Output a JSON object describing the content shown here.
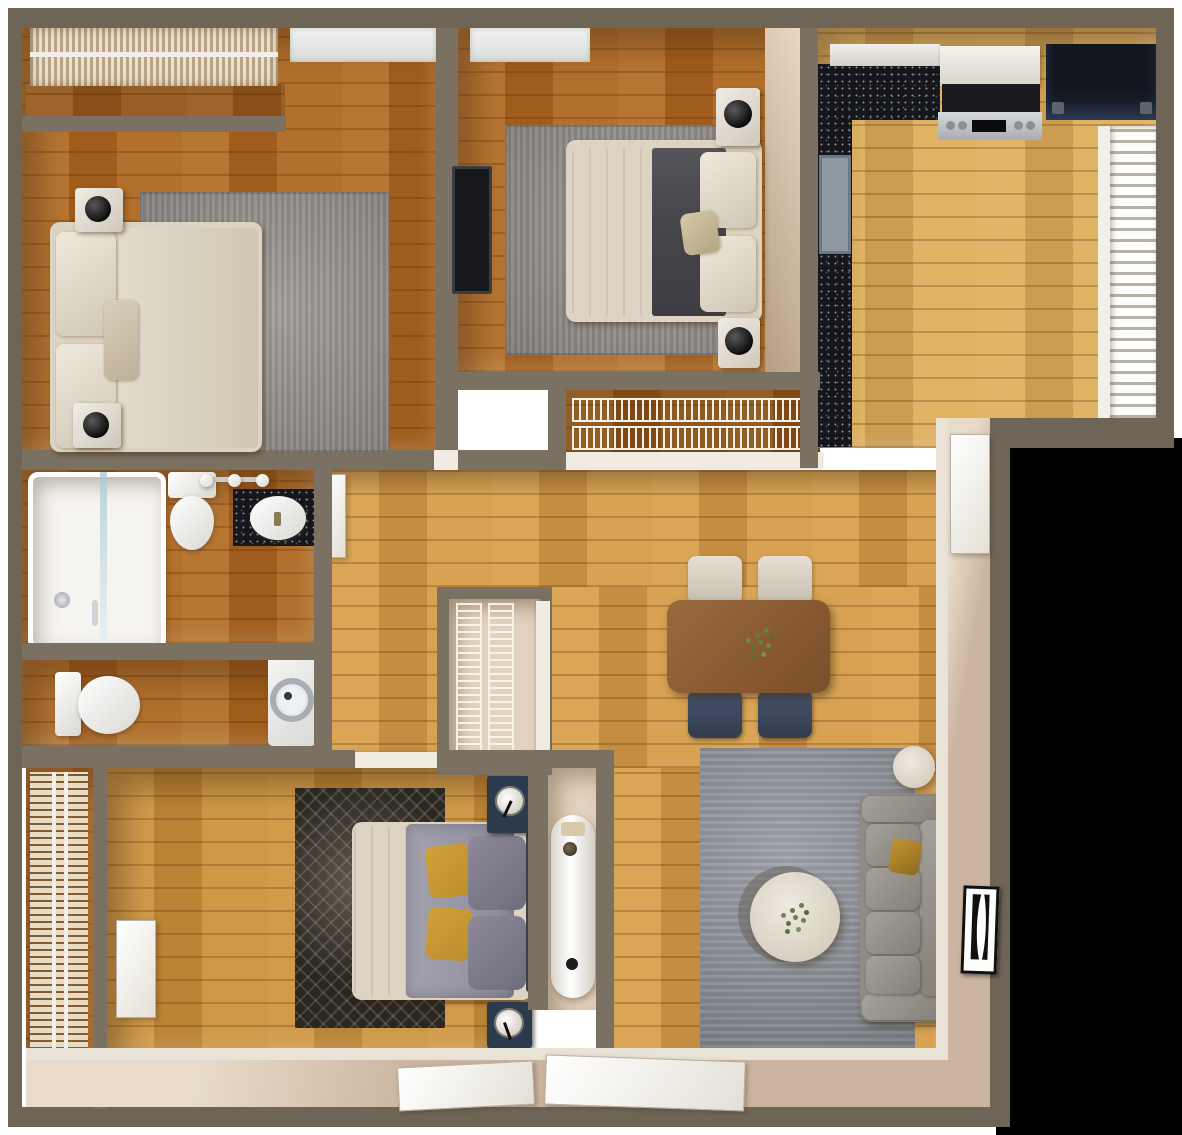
{
  "title": "Top-down 3D render floor plan of a two-bedroom-plus-den apartment",
  "palette": {
    "wall": "#6f6557",
    "wallInner": "#7b7163",
    "beige": "#e3d2bf",
    "beigeDeep": "#cdb9a2",
    "porch": "#cbb5a0",
    "woodDark": "#a9631f",
    "woodMid": "#c08236",
    "woodB3": "#c8913c",
    "woodHall": "#d39c4a",
    "woodKitchen": "#dcae5e",
    "rugGray": "#928d89",
    "rugLiving": "#8e929a",
    "rugDark": "#2a2620",
    "cream": "#ddd3c2",
    "linen": "#eae7e2",
    "duvet": "#9795a3",
    "blanket": "#46464a",
    "mustard": "#bc8d2c",
    "navy": "#2c3a4e",
    "chairNavy": "#3c4759",
    "chairWhite": "#ddd6ca",
    "sofa": "#8f8b86",
    "tableWood": "#8a5a33",
    "counter": "#16171c",
    "stainless": "#c0c3c6",
    "fridge": "#1c2330",
    "heater": "#efece6",
    "white": "#f4f2ee",
    "glass": "#dfe7ea",
    "plant": "#6a7d4a",
    "black": "#000000"
  },
  "rooms": {
    "bedroom1": {
      "label": "Bedroom 1 (top left)",
      "furniture": [
        "double bed with cream bedding",
        "two white nightstands with black sphere lamps",
        "gray area rug",
        "bay window with vertical-slat blinds"
      ]
    },
    "bedroom2": {
      "label": "Bedroom 2 (top middle)",
      "furniture": [
        "double bed with white sheet and charcoal runner",
        "two marble nightstands with dark sphere lamps",
        "wall-mounted TV",
        "gray area rug",
        "window"
      ]
    },
    "bedroom2Closet": {
      "label": "Bedroom 2 wire-shelf closet",
      "furniture": [
        "two wire shelving runs"
      ]
    },
    "kitchen": {
      "label": "Kitchen (top right)",
      "furniture": [
        "L-shaped black speckled countertop",
        "stainless range with black cooktop",
        "white hood cabinet",
        "dark refrigerator",
        "window with horizontal louvers",
        "blue-gray cabinet front"
      ]
    },
    "bathroom": {
      "label": "Main bathroom",
      "furniture": [
        "bathtub with glass screen",
        "toilet",
        "black vanity with oval white sink",
        "triple sconce light",
        "white door"
      ]
    },
    "wc": {
      "label": "Second bathroom / laundry",
      "furniture": [
        "toilet",
        "front-loading washer"
      ]
    },
    "windowRoom": {
      "label": "Left window alcove",
      "furniture": [
        "tall window with horizontal blinds"
      ]
    },
    "bedroom3": {
      "label": "Lower bedroom / den",
      "furniture": [
        "double bed with gray-lavender duvet and mustard pillows",
        "two navy nightstands with white round lamps",
        "dark patterned rug"
      ]
    },
    "linenCloset": {
      "label": "Hall linen closet",
      "furniture": [
        "vertical wire shelving"
      ]
    },
    "heaterNiche": {
      "label": "Water-heater niche",
      "furniture": [
        "white cylindrical water heater"
      ]
    },
    "living": {
      "label": "Living / dining area",
      "furniture": [
        "gray three-seat sofa with mustard throw pillow",
        "round cream coffee table with plant",
        "small round side table",
        "blue-gray area rug",
        "wood dining table with centerpiece plant",
        "two cream dining chairs",
        "two navy dining chairs"
      ]
    },
    "entry": {
      "label": "Entry",
      "furniture": [
        "white front door",
        "black-and-white hourglass wall art"
      ]
    },
    "porch": {
      "label": "Bottom threshold strip",
      "furniture": [
        "two open white door panels"
      ]
    }
  },
  "counts": {
    "bedrooms": 3,
    "bathrooms": 2,
    "dining_chairs": 4,
    "sofa_cushions": 4
  },
  "art": {
    "glyph": "hourglass-logo",
    "colors": [
      "#fdfdfb",
      "#111111"
    ]
  }
}
